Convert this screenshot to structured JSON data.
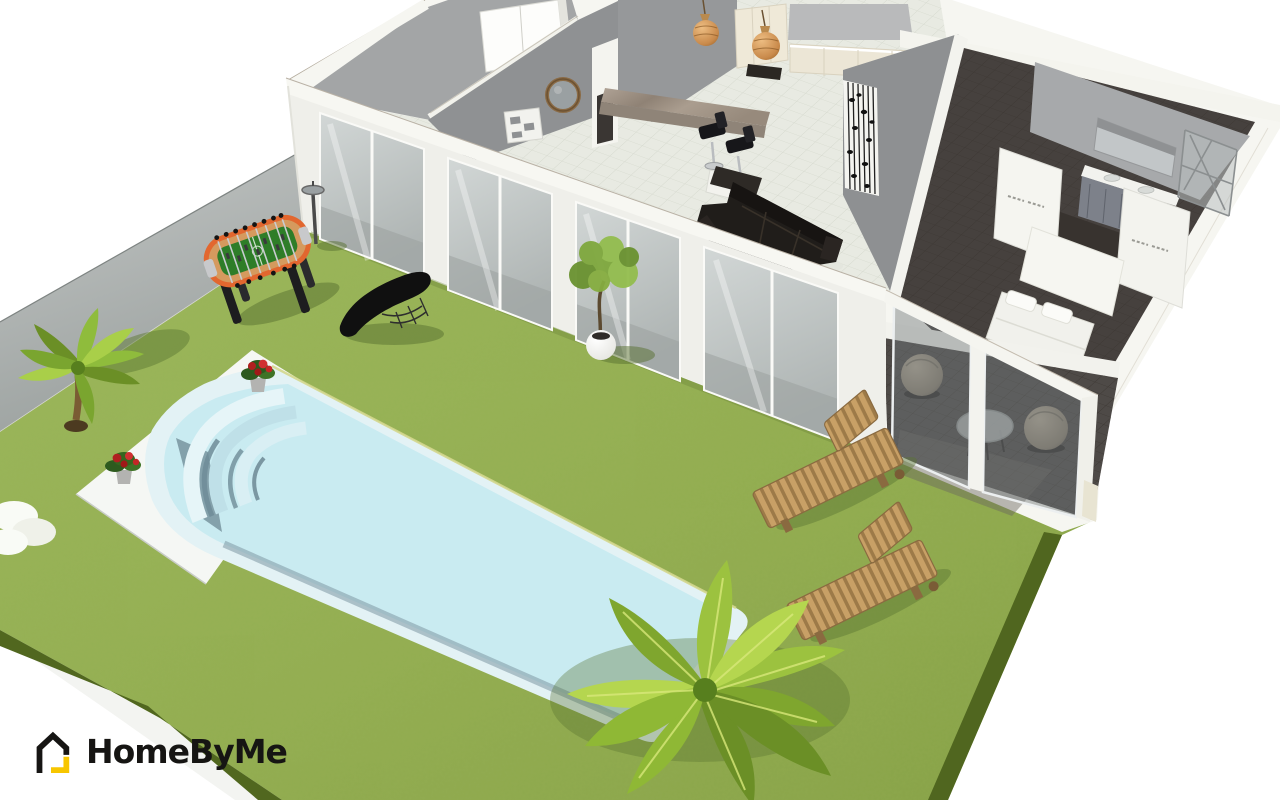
{
  "app": {
    "name": "HomeByMe"
  },
  "logo": {
    "text": "HomeByMe",
    "icon": "house-outline-icon",
    "icon_color": "#161513",
    "accent_color": "#f7c600",
    "text_color": "#161513"
  },
  "viewport": {
    "width": 1280,
    "height": 800,
    "view": "3d-perspective-home-plan"
  },
  "colors": {
    "background": "#ffffff",
    "grass": "#95b054",
    "grass_light": "#a3bd60",
    "grass_dark": "#50661f",
    "concrete": "#b7bab9",
    "concrete_dark": "#9aa09e",
    "path_white": "#f3f4f1",
    "deck": "#f5f7f4",
    "pool_coping": "#e3f2f5",
    "pool_water": "#c9ebf1",
    "pool_step_light": "#dff3f7",
    "pool_step_mid": "#bfe0e8",
    "pool_shadow": "#6f8c98",
    "pool_trim": "#d4d88e",
    "wall": "#f6f6f1",
    "wall_face": "#efefe9",
    "wall_gray": "#8f9193",
    "wall_gray_light": "#a7a9ab",
    "floor_tile": "#e8eae2",
    "grout": "#d0d4c8",
    "floor_dark": "#46413e",
    "floor_dark_line": "#39342f",
    "glass": "#c3c9c8",
    "glass_dark": "#9aa19f",
    "veranda_glass": "#70777a",
    "sofa": "#1d1a18",
    "cream": "#eee8d7",
    "cream_dark": "#d9d2bf",
    "marble": "#a0938a",
    "marble_dark": "#8f8478",
    "wood": "#c8a066",
    "wood_dark": "#9d7a48",
    "foosball_orange": "#e2672f",
    "foosball_wood": "#d59a5e",
    "foosball_field": "#2e7d28",
    "leaf": "#8fbc3c",
    "leaf_light": "#a9cf49",
    "leaf_dark": "#6b8f26",
    "flower_red": "#b02020",
    "pendant": "#cf9050",
    "shadow_green": "#57702f",
    "logo_black": "#161513",
    "logo_yellow": "#f7c600"
  },
  "scene": {
    "objects": [
      "lawn",
      "concrete-driveway-strip",
      "white-garden-path",
      "pool-deck",
      "swimming-pool",
      "pool-roman-steps",
      "flower-pot",
      "flower-pot",
      "palm-tree-small",
      "palm-tree-large",
      "garden-lamp",
      "foosball-table",
      "chaise-longue",
      "potted-tree",
      "sun-lounger",
      "sun-lounger",
      "white-shrub",
      "house",
      "garage-room",
      "hallway-wall-shelf",
      "round-wall-mirror",
      "hallway-door",
      "kitchen-cabinets",
      "kitchen-bar-counter",
      "bar-stool",
      "bar-stool",
      "pendant-light",
      "pendant-light",
      "kitchen-island",
      "sectional-sofa",
      "wall-art-panel",
      "bedroom-bed",
      "bed-headboard",
      "wardrobe",
      "wardrobe",
      "bathroom-vanity",
      "bathroom-mirror",
      "shower-enclosure",
      "veranda",
      "ball-chair",
      "ball-chair",
      "veranda-round-table",
      "sliding-glass-doors"
    ]
  }
}
